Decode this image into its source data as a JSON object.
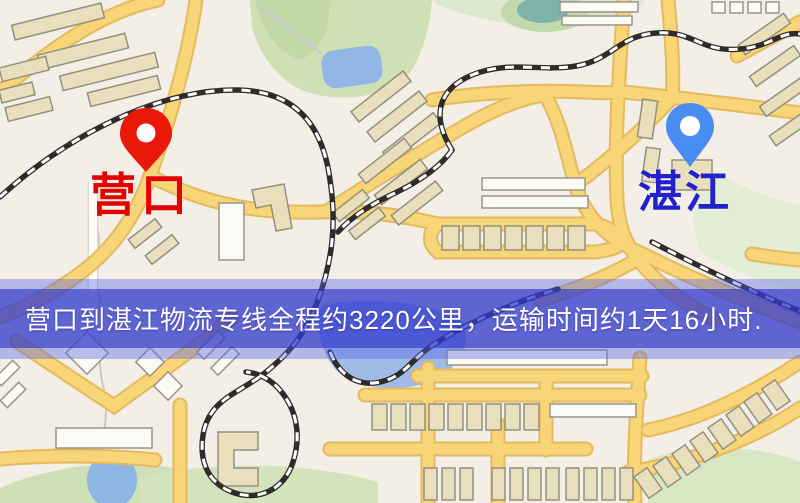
{
  "map": {
    "markers": [
      {
        "id": "yingkou",
        "label": "营口"
      },
      {
        "id": "zhanjiang",
        "label": "湛江"
      }
    ],
    "banner": {
      "text": "营口到湛江物流专线全程约3220公里，运输时间约1天16小时."
    }
  },
  "colors": {
    "pin-yingkou": "#ea1808",
    "pin-zhanjiang": "#4a8df2",
    "label-yingkou": "#e60000",
    "label-zhanjiang": "#2222cc",
    "banner-outer": "rgba(85,97,228,0.40)",
    "banner-inner": "rgba(44,50,200,0.62)",
    "banner-text": "#ffffff",
    "map-bg": "#f3efe7",
    "road": "#f8d577",
    "road-edge": "#e5b95e",
    "park": "#cfe0b4",
    "water": "#92b6e6",
    "railway": "#2e2c2a",
    "building": "#e9dfbd"
  }
}
